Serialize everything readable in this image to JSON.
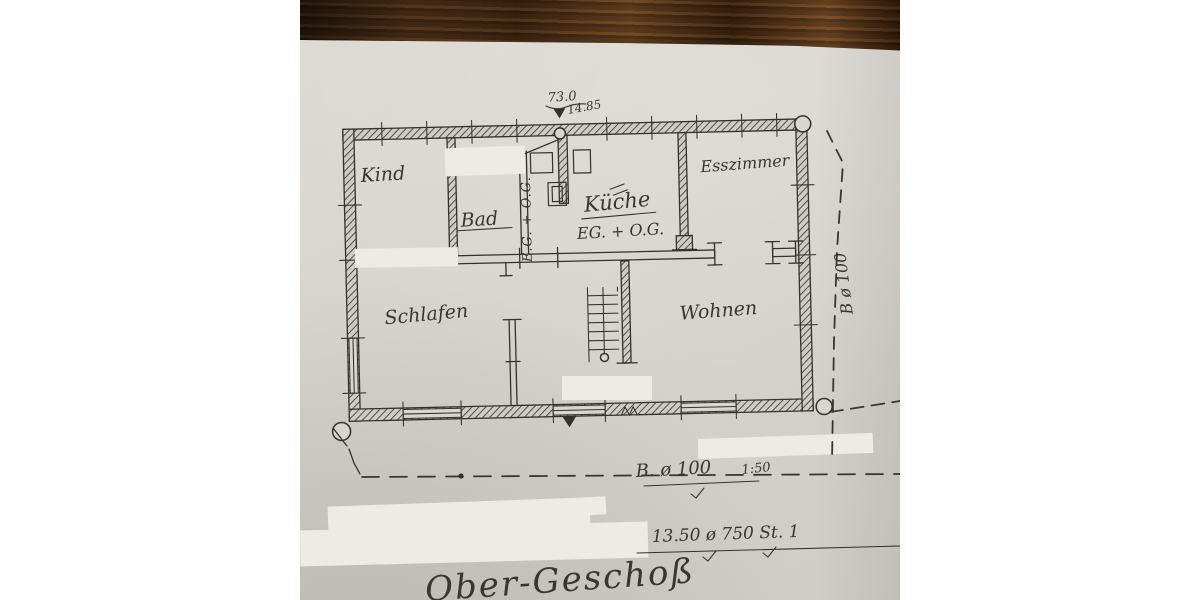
{
  "colors": {
    "paper": "#d7d4ce",
    "wood": "#4a2e18",
    "ink": "#35312b",
    "whiteout": "#ecebe6"
  },
  "plan": {
    "title": "Ober-Geschoß",
    "rooms": {
      "kind": "Kind",
      "bad": "Bad",
      "kueche": "Küche",
      "kueche_floor": "EG. + O.G.",
      "shaft": "E.G. + O.G.",
      "esszimmer": "Esszimmer",
      "schlafen": "Schlafen",
      "wohnen": "Wohnen"
    },
    "dimensions": {
      "top": "73.0",
      "top2": "14.85",
      "right": "B ø 100",
      "bottom": "B. ø 100",
      "scale": "1:50",
      "note": "13.50 ø 750 St. 1"
    }
  }
}
